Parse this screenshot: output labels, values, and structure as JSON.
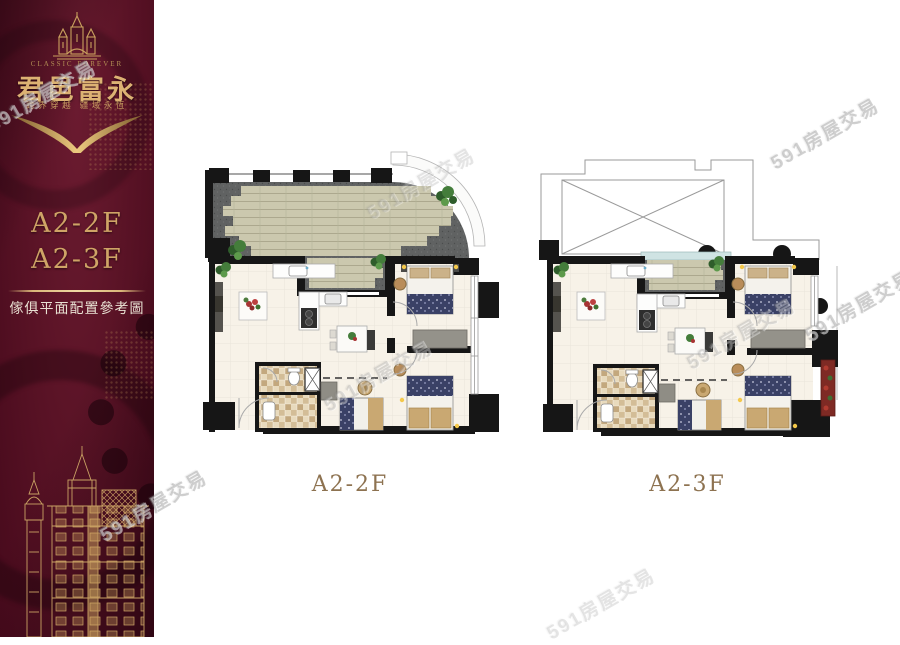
{
  "brand": {
    "logo_caption": "CLASSIC FOREVER",
    "name": "君邑富永",
    "tagline": "跨界穿越 疆域永恆"
  },
  "sidebar": {
    "unit_line1": "A2-2F",
    "unit_line2": "A2-3F",
    "caption": "傢俱平面配置參考圖"
  },
  "plans": [
    {
      "label": "A2-2F"
    },
    {
      "label": "A2-3F"
    }
  ],
  "watermark": {
    "text": "591房屋交易"
  },
  "colors": {
    "sidebar_maroon": "#5a1326",
    "gold": "#cfa466",
    "label_brown": "#8d7250",
    "wall_black": "#161616",
    "deck_plank": "#cbc8ae",
    "gravel_gray": "#606262",
    "bed_navy": "#3a4166",
    "bath_tile_tan": "#d3bd97",
    "plant_green": "#447d3b",
    "planter_red": "#7e2a24"
  }
}
